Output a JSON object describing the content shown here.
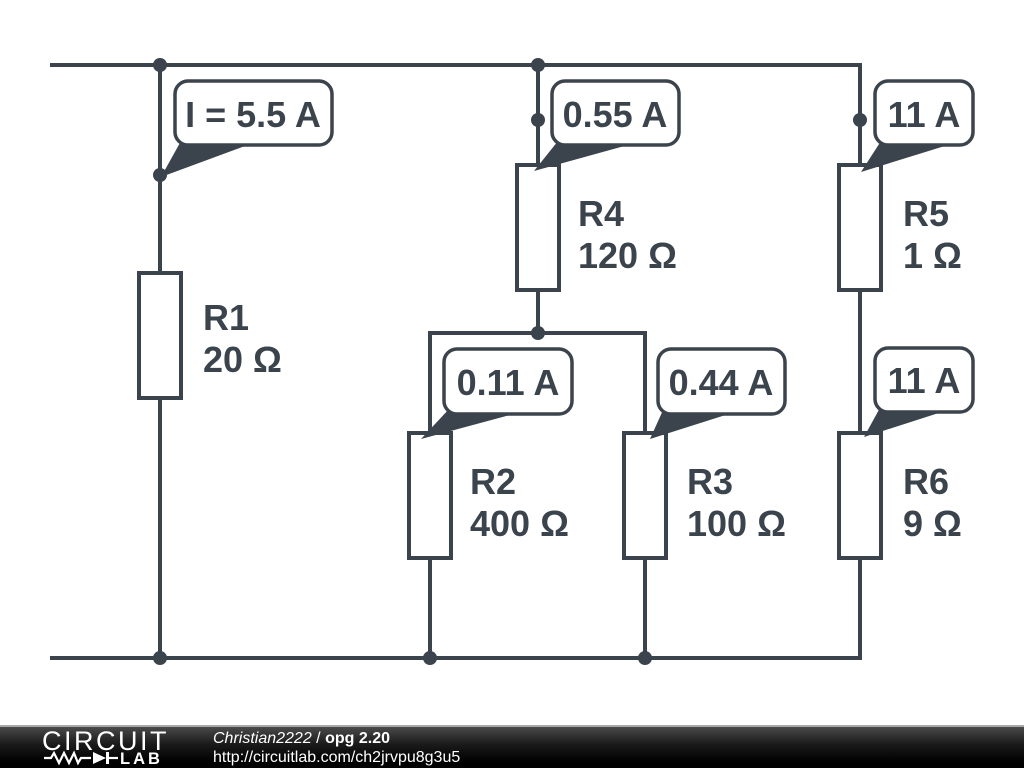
{
  "page": {
    "background": "#ffffff",
    "ink_color": "#3b444c"
  },
  "circuit": {
    "resistors": [
      {
        "name": "R1",
        "value": "20 Ω"
      },
      {
        "name": "R2",
        "value": "400 Ω"
      },
      {
        "name": "R3",
        "value": "100 Ω"
      },
      {
        "name": "R4",
        "value": "120 Ω"
      },
      {
        "name": "R5",
        "value": "1 Ω"
      },
      {
        "name": "R6",
        "value": "9 Ω"
      }
    ],
    "current_callouts": [
      {
        "near": "R1",
        "label": "I = 5.5 A"
      },
      {
        "near": "R4",
        "label": "0.55 A"
      },
      {
        "near": "R5",
        "label": "11 A"
      },
      {
        "near": "R2",
        "label": "0.11 A"
      },
      {
        "near": "R3",
        "label": "0.44 A"
      },
      {
        "near": "R6",
        "label": "11 A"
      }
    ]
  },
  "footer": {
    "logo_line1": "CIRCUIT",
    "logo_line2": "LAB",
    "author": "Christian2222",
    "separator": " / ",
    "title": "opg 2.20",
    "url": "http://circuitlab.com/ch2jrvpu8g3u5"
  }
}
